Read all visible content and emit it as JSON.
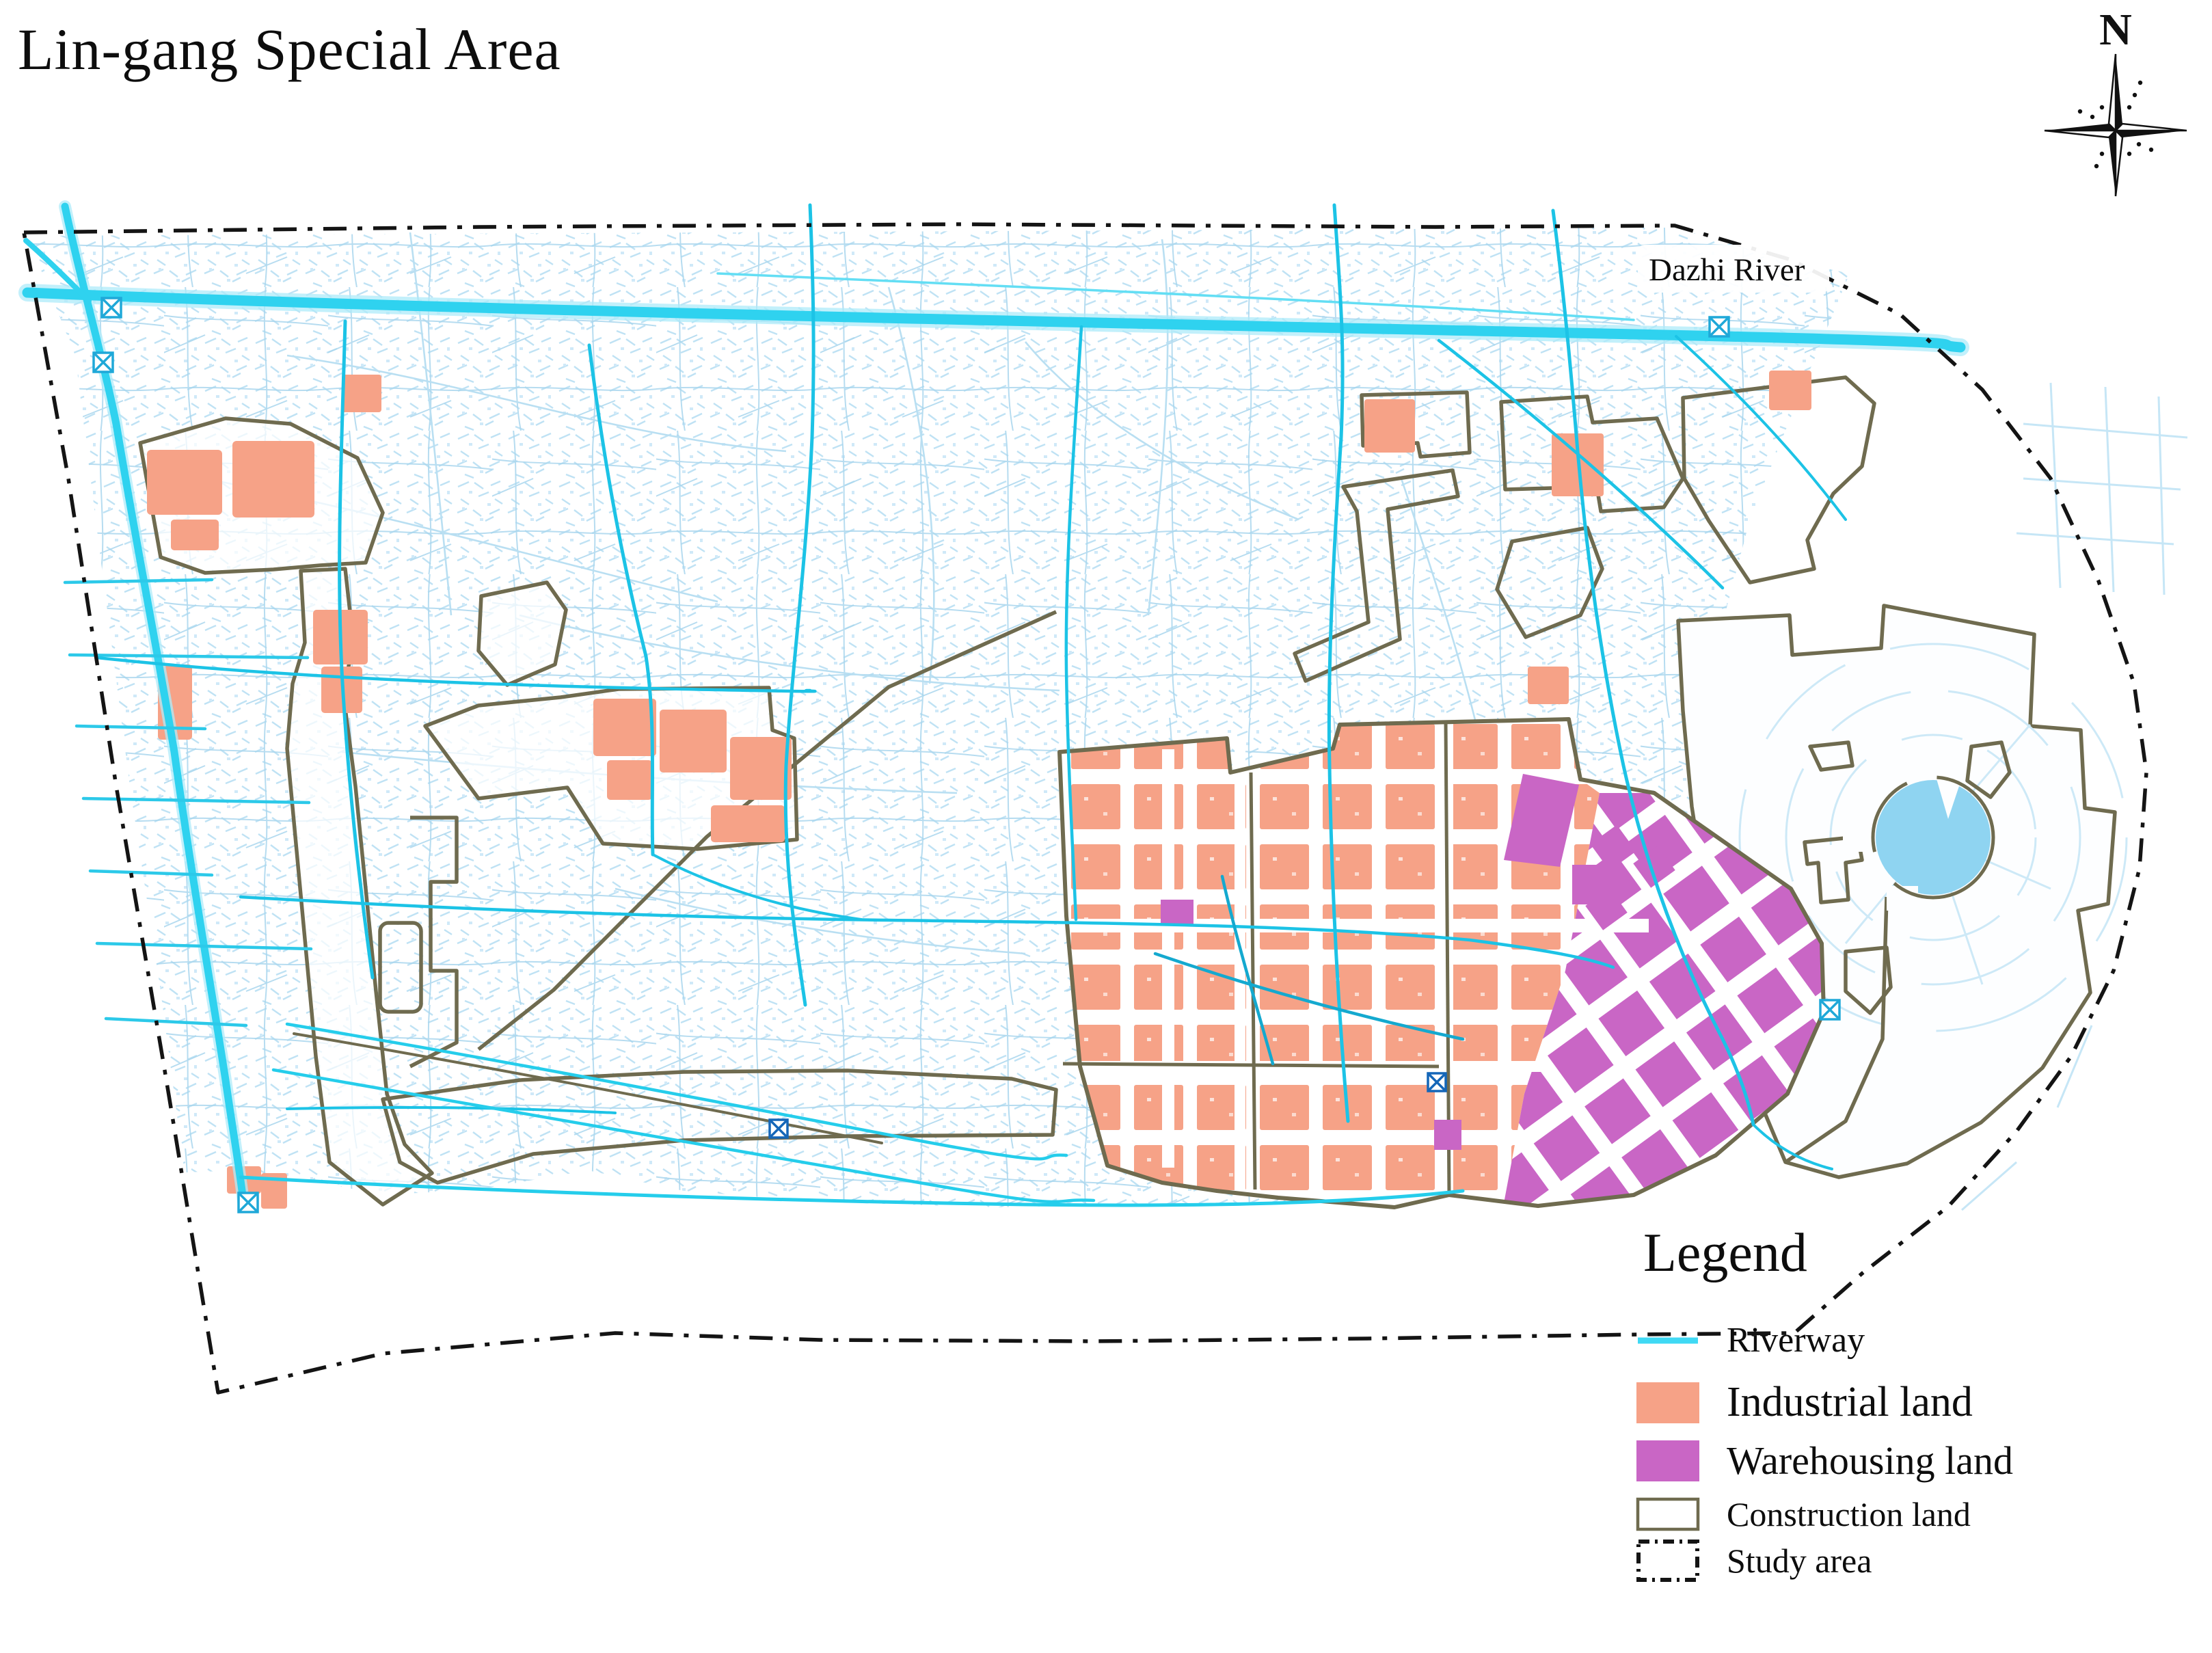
{
  "title": "Lin-gang Special Area",
  "compass": {
    "label": "N"
  },
  "map": {
    "river_label": "Dazhi River"
  },
  "legend": {
    "title": "Legend",
    "items": [
      {
        "id": "riverway",
        "label": "Riverway",
        "swatch": "line",
        "color": "#3fd9f4"
      },
      {
        "id": "industrial-land",
        "label": "Industrial land",
        "swatch": "fill",
        "color": "#f6a287"
      },
      {
        "id": "warehousing-land",
        "label": "Warehousing land",
        "swatch": "fill",
        "color": "#c966c5"
      },
      {
        "id": "construction-land",
        "label": "Construction land",
        "swatch": "outline",
        "color": "#6f6b4f"
      },
      {
        "id": "study-area",
        "label": "Study area",
        "swatch": "dashdot",
        "color": "#141414"
      }
    ]
  },
  "colors": {
    "riverway": "#2fd2ef",
    "riverway_halo": "#aeebfa",
    "industrial": "#f6a287",
    "warehousing": "#c966c5",
    "construction_outline": "#6f6b4f",
    "study_boundary": "#141414",
    "lake": "#8fd4f1",
    "texture": "#bfe2f4"
  }
}
